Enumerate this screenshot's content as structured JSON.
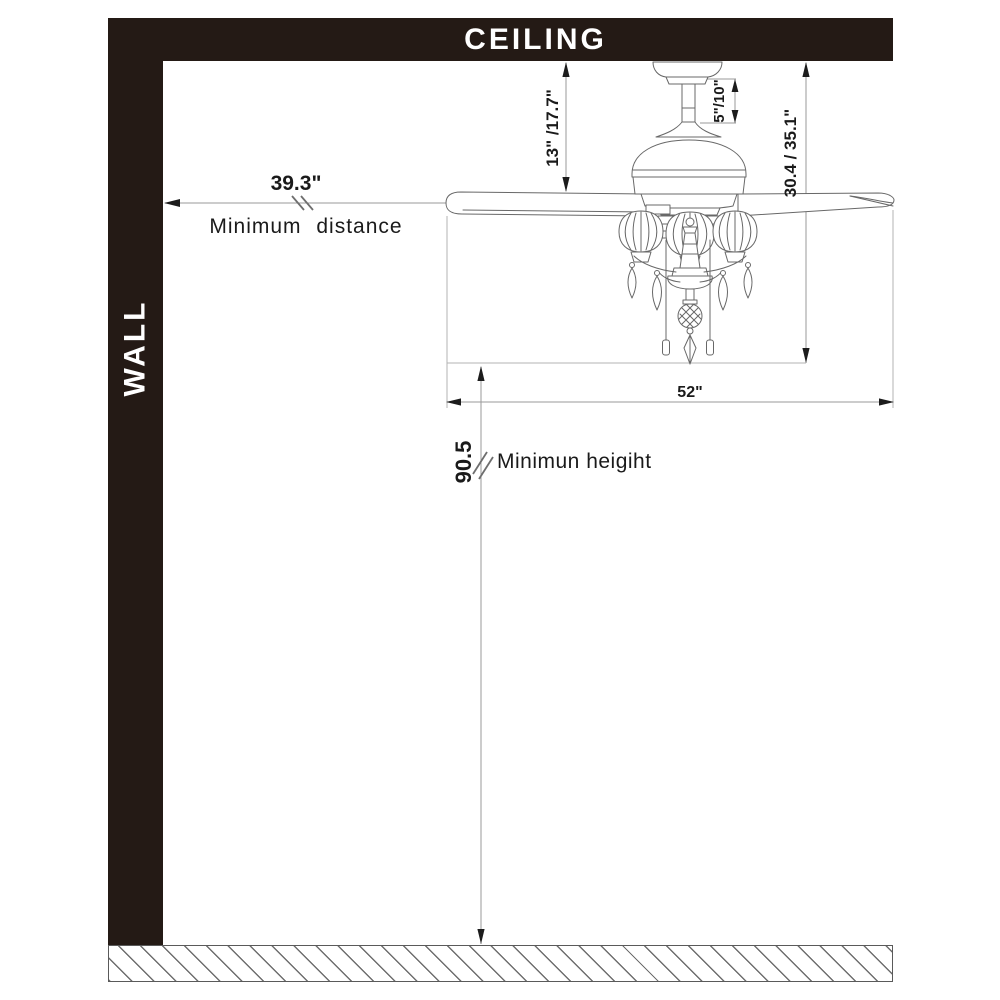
{
  "diagram": {
    "ceiling_label": "CEILING",
    "wall_label": "WALL",
    "dimensions": {
      "min_distance_value": "39.3\"",
      "min_distance_label": "Minimum distance",
      "hanger_height": "13\" /17.7\"",
      "downrod_length": "5\"/10\"",
      "total_height": "30.4 / 35.1\"",
      "blade_sweep": "52\"",
      "min_height_value": "90.5",
      "min_height_label": "Minimun heigiht"
    },
    "colors": {
      "structure": "#241a15",
      "text": "#1a1a1a",
      "dimension_line": "#9a9a9a",
      "drawing_line": "#686868"
    }
  }
}
